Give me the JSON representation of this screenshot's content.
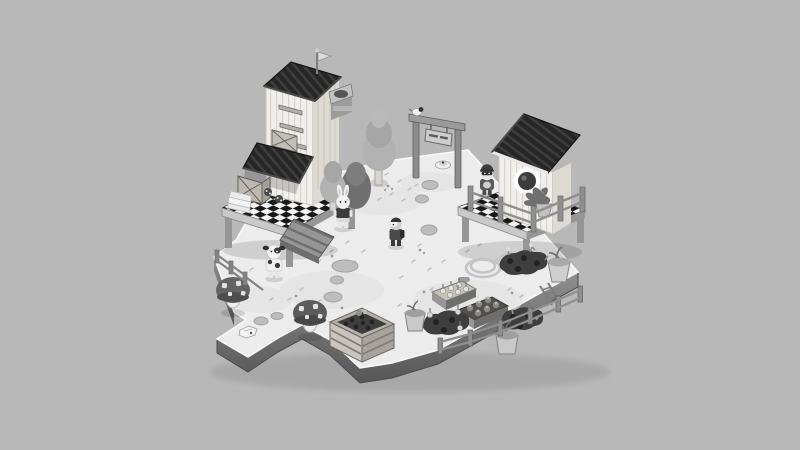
{
  "app": {
    "title": "Isometric farm diorama (grayscale game scene)",
    "view": "floating island plot on flat gray backdrop"
  },
  "palette": {
    "bg": "#b8b8b8",
    "floor": "#ececec",
    "floorlo": "#e0e0e0",
    "side": "#8f8f8f",
    "sidelo": "#565656",
    "roof": "#262626",
    "rib": "#3d3d3d",
    "wall": "#f1efec",
    "wallline": "#d7d3cd",
    "wallshade": "#ddd9d3",
    "woodl": "#c9c9c9",
    "woodm": "#969696",
    "woodd": "#6e6e6e",
    "ckd": "#181818",
    "ckl": "#f5f5f5",
    "soil": "#3e3e3e",
    "leafl": "#b2b2b2",
    "leafd": "#6f6f6f",
    "stone": "#bdbdbd",
    "ink": "#2f2f2f",
    "wht": "#f6f6f6"
  },
  "gate_sign": {
    "text": "",
    "legible": false
  },
  "objects": {
    "buildings": [
      {
        "name": "tall-barn",
        "features": [
          "striped plank walls",
          "dark slatted roof",
          "flag pole",
          "wall ledges",
          "crate in opening",
          "slatted awning",
          "wall-mounted box"
        ]
      },
      {
        "name": "chicken-coop",
        "features": [
          "round porthole window",
          "dark slatted roof",
          "checkered deck with railing",
          "potted plant"
        ]
      }
    ],
    "characters": [
      {
        "name": "bunny-villager",
        "pos": "center-left near trees"
      },
      {
        "name": "villager-center",
        "pos": "middle of plaza"
      },
      {
        "name": "cow-villager",
        "pos": "lower-left near mushrooms"
      },
      {
        "name": "raccoon-villager",
        "pos": "on coop deck"
      },
      {
        "name": "bird",
        "pos": "on gate post"
      }
    ],
    "props": [
      "checkered-deck-table",
      "wooden-crates",
      "paper-stack",
      "ladybugs",
      "gate-arch-with-sign",
      "egg-dish",
      "stepping-stones",
      "wooden-ramp",
      "spotted-mushroom-1",
      "spotted-mushroom-2",
      "compost-planter-crate",
      "seedling-trays",
      "soil-plots",
      "plant-pots",
      "garden-fence",
      "mini-ladder",
      "garden-hose-coil",
      "left-fence",
      "dropped-paper",
      "trees",
      "dark-bush"
    ]
  }
}
